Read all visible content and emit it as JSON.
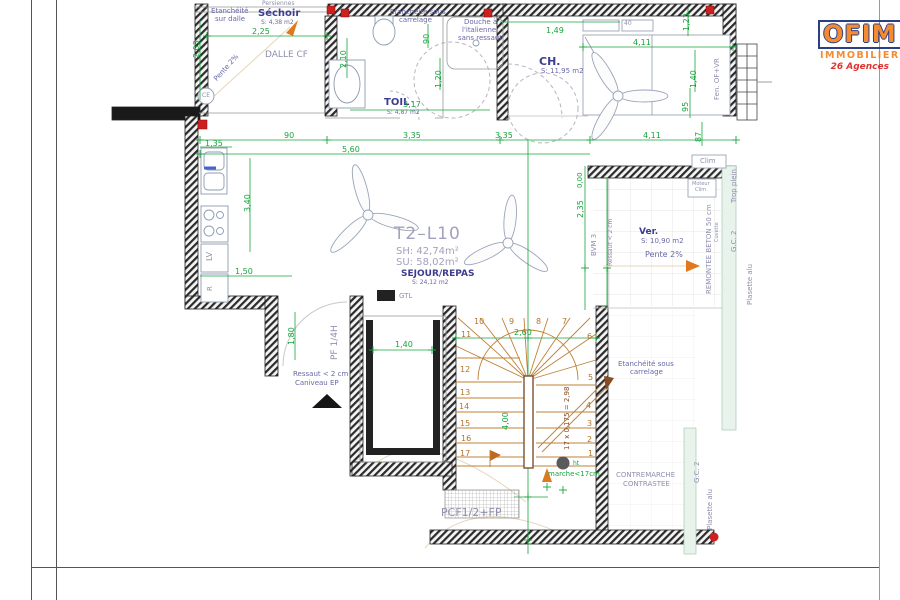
{
  "page": {
    "type": "architectural-floor-plan"
  },
  "logo": {
    "brand": "OFIM",
    "subtitle": "IMMOBILIER",
    "tagline": "26 Agences"
  },
  "plan": {
    "unit": "T2–L10",
    "surface_habitable": "SH: 42,74m²",
    "surface_utile": "SU: 58,02m²",
    "rooms": [
      {
        "name": "Séchoir",
        "area": "S: 4,38 m2"
      },
      {
        "name": "TOIL",
        "area": "S: 4,87 m2"
      },
      {
        "name": "CH.",
        "area": "S: 11,95 m2"
      },
      {
        "name": "SEJOUR/REPAS",
        "area": "S: 24,12 m2"
      },
      {
        "name": "Ver.",
        "area": "S: 10,90 m2"
      }
    ],
    "stairs": {
      "steps": 17,
      "formula": "17 x 0,175 = 2,98",
      "note_contremarche": "CONTREMARCHE CONTRASTEE",
      "note_marche": "ht marche<17cm"
    }
  },
  "colors": {
    "dimension_green": "#17a53c",
    "label_navy": "#3d3d8f",
    "stair_orange": "#c08035",
    "logo_orange": "#f58220",
    "tagline_red": "#e02020",
    "wall_black": "#1a1a1a"
  },
  "labels": [
    {
      "n": "note-etancheite-sur-dalle-1",
      "t": "Etanchéité",
      "x": 211,
      "y": 8,
      "c": "s"
    },
    {
      "n": "note-etancheite-sur-dalle-2",
      "t": "sur dalle",
      "x": 215,
      "y": 16,
      "c": "s"
    },
    {
      "n": "note-persiennes",
      "t": "Persiennes",
      "x": 262,
      "y": 1,
      "c": "gr",
      "fs": 6
    },
    {
      "n": "room-label-sechoir",
      "t": "Séchoir",
      "x": 258,
      "y": 9,
      "c": "b",
      "fs": 10
    },
    {
      "n": "room-area-sechoir",
      "t": "S: 4,38 m2",
      "x": 261,
      "y": 20,
      "c": "s",
      "fs": 6
    },
    {
      "n": "dim-2-25",
      "t": "2,25",
      "x": 252,
      "y": 28,
      "c": "g"
    },
    {
      "n": "dim-2-03",
      "t": "2,03",
      "x": 193,
      "y": 58,
      "c": "g",
      "r": -90
    },
    {
      "n": "label-dalle-cf",
      "t": "DALLE CF",
      "x": 265,
      "y": 51,
      "c": "gr",
      "fs": 9
    },
    {
      "n": "note-pente-sechoir",
      "t": "Pente 2%",
      "x": 213,
      "y": 78,
      "c": "s",
      "r": -48
    },
    {
      "n": "label-ce",
      "t": "CE",
      "x": 202,
      "y": 93,
      "c": "gr",
      "fs": 6
    },
    {
      "n": "note-etancheite-carrelage-top-1",
      "t": "Etanchéité sous",
      "x": 390,
      "y": 9,
      "c": "s"
    },
    {
      "n": "note-etancheite-carrelage-top-2",
      "t": "carrelage",
      "x": 399,
      "y": 17,
      "c": "s"
    },
    {
      "n": "note-douche-1",
      "t": "Douche à",
      "x": 464,
      "y": 19,
      "c": "s"
    },
    {
      "n": "note-douche-2",
      "t": "l'italienne",
      "x": 462,
      "y": 27,
      "c": "s"
    },
    {
      "n": "note-douche-3",
      "t": "sans ressaut",
      "x": 458,
      "y": 35,
      "c": "s"
    },
    {
      "n": "room-label-toil",
      "t": "TOIL",
      "x": 384,
      "y": 98,
      "c": "b",
      "fs": 10
    },
    {
      "n": "room-area-toil",
      "t": "S: 4,87 m2",
      "x": 387,
      "y": 110,
      "c": "s",
      "fs": 6
    },
    {
      "n": "dim-2-10",
      "t": "2,10",
      "x": 340,
      "y": 68,
      "c": "g",
      "r": -90
    },
    {
      "n": "dim-90-v",
      "t": "90",
      "x": 423,
      "y": 44,
      "c": "g",
      "r": -90
    },
    {
      "n": "dim-1-20",
      "t": "1,20",
      "x": 435,
      "y": 88,
      "c": "g",
      "r": -90
    },
    {
      "n": "dim-3-17",
      "t": "3,17",
      "x": 403,
      "y": 101,
      "c": "g"
    },
    {
      "n": "room-label-ch",
      "t": "CH.",
      "x": 539,
      "y": 56,
      "c": "b"
    },
    {
      "n": "room-area-ch",
      "t": "S: 11,95 m2",
      "x": 541,
      "y": 68,
      "c": "s"
    },
    {
      "n": "dim-1-49",
      "t": "1,49",
      "x": 546,
      "y": 27,
      "c": "g"
    },
    {
      "n": "dim-4-11-a",
      "t": "4,11",
      "x": 633,
      "y": 39,
      "c": "g"
    },
    {
      "n": "dim-40",
      "t": "40",
      "x": 624,
      "y": 21,
      "c": "gr",
      "fs": 6
    },
    {
      "n": "dim-95",
      "t": "95",
      "x": 682,
      "y": 112,
      "c": "g",
      "r": -90
    },
    {
      "n": "dim-87",
      "t": "87",
      "x": 695,
      "y": 142,
      "c": "g",
      "r": -90
    },
    {
      "n": "dim-1-23",
      "t": "1,23",
      "x": 683,
      "y": 31,
      "c": "g",
      "r": -90
    },
    {
      "n": "dim-1-40-window",
      "t": "1,40",
      "x": 690,
      "y": 88,
      "c": "g",
      "r": -90
    },
    {
      "n": "label-fenetre",
      "t": "Fen. OF+VR",
      "x": 714,
      "y": 100,
      "c": "gr",
      "r": -90,
      "fs": 7
    },
    {
      "n": "label-clim",
      "t": "Clim",
      "x": 700,
      "y": 158,
      "c": "gr",
      "fs": 7
    },
    {
      "n": "label-moteur-clim-1",
      "t": "Moteur",
      "x": 692,
      "y": 182,
      "c": "gr",
      "fs": 5
    },
    {
      "n": "label-moteur-clim-2",
      "t": "Clim",
      "x": 695,
      "y": 188,
      "c": "gr",
      "fs": 5
    },
    {
      "n": "dim-90",
      "t": "90",
      "x": 284,
      "y": 132,
      "c": "g"
    },
    {
      "n": "dim-3-35-a",
      "t": "3,35",
      "x": 403,
      "y": 132,
      "c": "g"
    },
    {
      "n": "dim-3-35-b",
      "t": "3,35",
      "x": 495,
      "y": 132,
      "c": "g"
    },
    {
      "n": "dim-4-11-b",
      "t": "4,11",
      "x": 643,
      "y": 132,
      "c": "g"
    },
    {
      "n": "dim-5-60",
      "t": "5,60",
      "x": 342,
      "y": 146,
      "c": "g"
    },
    {
      "n": "dim-1-35",
      "t": "1,35",
      "x": 205,
      "y": 140,
      "c": "g"
    },
    {
      "n": "dim-3-40",
      "t": "3,40",
      "x": 244,
      "y": 212,
      "c": "g",
      "r": -90
    },
    {
      "n": "dim-1-50",
      "t": "1,50",
      "x": 235,
      "y": 268,
      "c": "g"
    },
    {
      "n": "label-lv",
      "t": "LV",
      "x": 206,
      "y": 261,
      "c": "gr",
      "r": -90,
      "fs": 8
    },
    {
      "n": "label-r",
      "t": "R",
      "x": 207,
      "y": 291,
      "c": "gr",
      "r": -90,
      "fs": 7
    },
    {
      "n": "dim-1-80",
      "t": "1,80",
      "x": 288,
      "y": 345,
      "c": "g",
      "r": -90
    },
    {
      "n": "label-pf-quart-h",
      "t": "PF 1/4H",
      "x": 331,
      "y": 360,
      "c": "gr",
      "r": -90,
      "fs": 9
    },
    {
      "n": "note-ressaut-entree-1",
      "t": "Ressaut < 2 cm",
      "x": 293,
      "y": 371,
      "c": "s"
    },
    {
      "n": "note-ressaut-entree-2",
      "t": "Caniveau EP",
      "x": 295,
      "y": 380,
      "c": "s"
    },
    {
      "n": "label-gtl",
      "t": "GTL",
      "x": 399,
      "y": 293,
      "c": "gr",
      "fs": 7
    },
    {
      "n": "dim-1-40-gaine",
      "t": "1,40",
      "x": 395,
      "y": 341,
      "c": "g"
    },
    {
      "n": "unit-label",
      "t": "T2–L10",
      "x": 394,
      "y": 226,
      "c": "t1"
    },
    {
      "n": "unit-sh",
      "t": "SH: 42,74m²",
      "x": 396,
      "y": 247,
      "c": "t2"
    },
    {
      "n": "unit-su",
      "t": "SU: 58,02m²",
      "x": 396,
      "y": 258,
      "c": "t2"
    },
    {
      "n": "room-label-sejour",
      "t": "SEJOUR/REPAS",
      "x": 401,
      "y": 270,
      "c": "b",
      "fs": 9
    },
    {
      "n": "room-area-sejour",
      "t": "S: 24,12 m2",
      "x": 412,
      "y": 280,
      "c": "s",
      "fs": 6
    },
    {
      "n": "level-0-00",
      "t": "0,00",
      "x": 577,
      "y": 188,
      "c": "g",
      "r": -90,
      "fs": 7
    },
    {
      "n": "dim-2-35",
      "t": "2,35",
      "x": 577,
      "y": 218,
      "c": "g",
      "r": -90
    },
    {
      "n": "room-label-veranda",
      "t": "Ver.",
      "x": 639,
      "y": 228,
      "c": "b",
      "fs": 9
    },
    {
      "n": "room-area-veranda",
      "t": "S: 10,90 m2",
      "x": 641,
      "y": 238,
      "c": "s"
    },
    {
      "n": "note-pente-veranda",
      "t": "Pente 2%",
      "x": 645,
      "y": 251,
      "c": "s",
      "fs": 8
    },
    {
      "n": "note-ressaut-veranda",
      "t": "Ressaut < 2 cm",
      "x": 608,
      "y": 266,
      "c": "gr",
      "r": -90,
      "fs": 6
    },
    {
      "n": "label-bvm-3",
      "t": "BVM 3",
      "x": 591,
      "y": 256,
      "c": "gr",
      "r": -90,
      "fs": 7
    },
    {
      "n": "note-remontee-beton",
      "t": "REMONTEE BETON 50 cm",
      "x": 706,
      "y": 294,
      "c": "gr",
      "r": -90,
      "fs": 7
    },
    {
      "n": "label-cuvette",
      "t": "Cuvette",
      "x": 715,
      "y": 242,
      "c": "gr",
      "r": -90,
      "fs": 5
    },
    {
      "n": "label-trop-plein",
      "t": "Trop plein",
      "x": 731,
      "y": 203,
      "c": "gr",
      "r": -90,
      "fs": 7
    },
    {
      "n": "label-gc2-haut",
      "t": "G.C. 2",
      "x": 731,
      "y": 252,
      "c": "gr",
      "r": -90,
      "fs": 7
    },
    {
      "n": "label-plasette-alu-haut",
      "t": "Plasette alu",
      "x": 747,
      "y": 305,
      "c": "gr",
      "r": -90,
      "fs": 7
    },
    {
      "n": "dim-2-60",
      "t": "2,60",
      "x": 514,
      "y": 329,
      "c": "g"
    },
    {
      "n": "dim-4-00",
      "t": "4,00",
      "x": 502,
      "y": 430,
      "c": "g",
      "r": -90
    },
    {
      "n": "note-escalier-formule",
      "t": "17 x 0,175 = 2,98",
      "x": 564,
      "y": 450,
      "c": "o",
      "r": -90
    },
    {
      "n": "stair-step-10",
      "t": "10",
      "x": 474,
      "y": 318,
      "c": "num"
    },
    {
      "n": "stair-step-9",
      "t": "9",
      "x": 509,
      "y": 318,
      "c": "num"
    },
    {
      "n": "stair-step-8",
      "t": "8",
      "x": 536,
      "y": 318,
      "c": "num"
    },
    {
      "n": "stair-step-7",
      "t": "7",
      "x": 562,
      "y": 318,
      "c": "num"
    },
    {
      "n": "stair-step-11",
      "t": "11",
      "x": 461,
      "y": 331,
      "c": "num"
    },
    {
      "n": "stair-step-12",
      "t": "12",
      "x": 460,
      "y": 366,
      "c": "num"
    },
    {
      "n": "stair-step-13",
      "t": "13",
      "x": 460,
      "y": 389,
      "c": "num"
    },
    {
      "n": "stair-step-14",
      "t": "14",
      "x": 459,
      "y": 403,
      "c": "num"
    },
    {
      "n": "stair-step-15",
      "t": "15",
      "x": 460,
      "y": 420,
      "c": "num"
    },
    {
      "n": "stair-step-16",
      "t": "16",
      "x": 461,
      "y": 435,
      "c": "num"
    },
    {
      "n": "stair-step-17",
      "t": "17",
      "x": 460,
      "y": 450,
      "c": "num"
    },
    {
      "n": "stair-step-6",
      "t": "6",
      "x": 587,
      "y": 333,
      "c": "num"
    },
    {
      "n": "stair-step-5",
      "t": "5",
      "x": 588,
      "y": 374,
      "c": "num"
    },
    {
      "n": "stair-step-4",
      "t": "4",
      "x": 586,
      "y": 402,
      "c": "num"
    },
    {
      "n": "stair-step-3",
      "t": "3",
      "x": 587,
      "y": 420,
      "c": "num"
    },
    {
      "n": "stair-step-2",
      "t": "2",
      "x": 587,
      "y": 436,
      "c": "num"
    },
    {
      "n": "stair-step-1",
      "t": "1",
      "x": 588,
      "y": 450,
      "c": "num"
    },
    {
      "n": "note-ht-marche-1",
      "t": "ht",
      "x": 573,
      "y": 461,
      "c": "grn",
      "fs": 6
    },
    {
      "n": "note-ht-marche-2",
      "t": "marche<17cm",
      "x": 548,
      "y": 471,
      "c": "grn"
    },
    {
      "n": "note-contremarche-1",
      "t": "CONTREMARCHE",
      "x": 616,
      "y": 472,
      "c": "gr",
      "fs": 7
    },
    {
      "n": "note-contremarche-2",
      "t": "CONTRASTEE",
      "x": 623,
      "y": 481,
      "c": "gr",
      "fs": 7
    },
    {
      "n": "note-etancheite-carrelage-bas-1",
      "t": "Etanchéité sous",
      "x": 618,
      "y": 361,
      "c": "s"
    },
    {
      "n": "note-etancheite-carrelage-bas-2",
      "t": "carrelage",
      "x": 630,
      "y": 369,
      "c": "s"
    },
    {
      "n": "label-pcf",
      "t": "PCF1/2+FP",
      "x": 441,
      "y": 507,
      "c": "gr",
      "fs": 11
    },
    {
      "n": "label-gc2-bas",
      "t": "G.C. 2",
      "x": 694,
      "y": 483,
      "c": "gr",
      "r": -90,
      "fs": 7
    },
    {
      "n": "label-plasette-alu-bas",
      "t": "Plasette alu",
      "x": 707,
      "y": 530,
      "c": "gr",
      "r": -90,
      "fs": 7
    }
  ]
}
